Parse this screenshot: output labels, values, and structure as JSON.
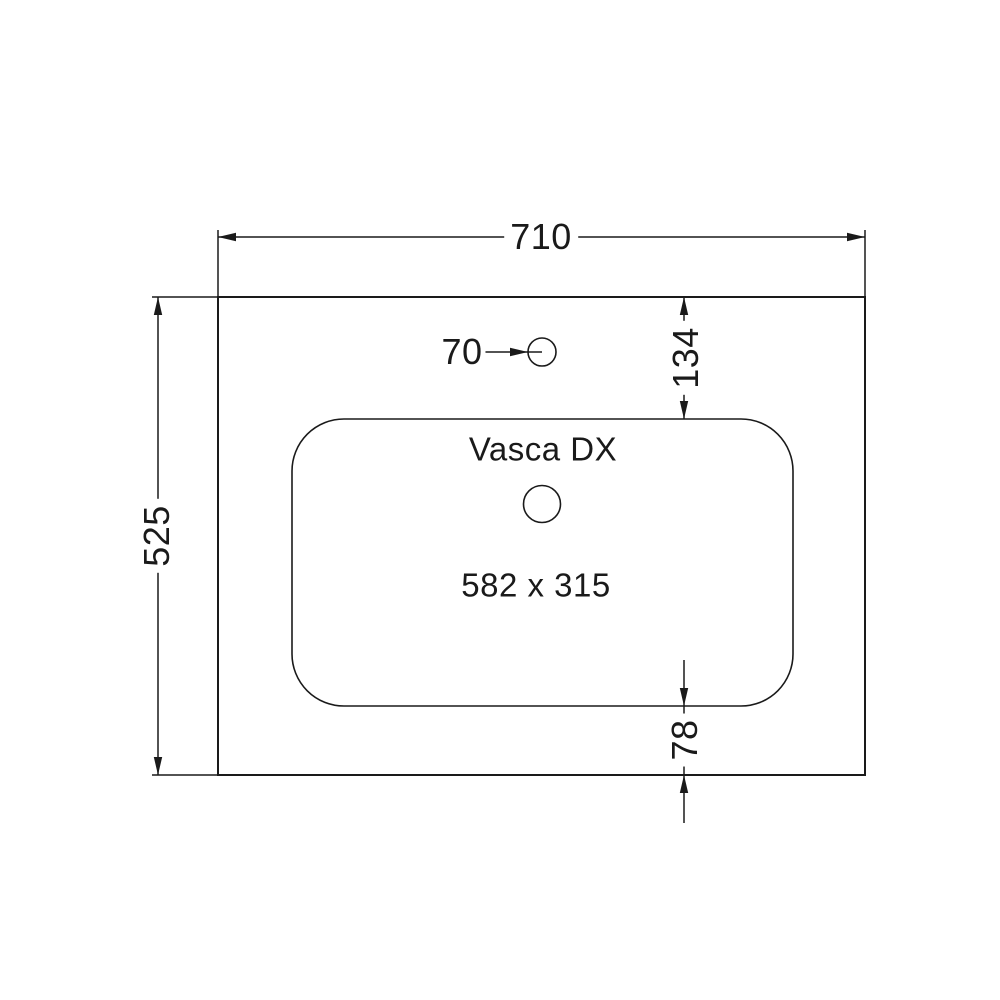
{
  "drawing": {
    "title": "Vasca DX",
    "basin_size_label": "582 x 315",
    "dims": {
      "overall_width": "710",
      "overall_depth": "525",
      "faucet_hole_diameter": "70",
      "faucet_offset_top": "134",
      "basin_offset_bottom": "78"
    }
  },
  "colors": {
    "line": "#1a1a1a",
    "background": "#ffffff"
  }
}
